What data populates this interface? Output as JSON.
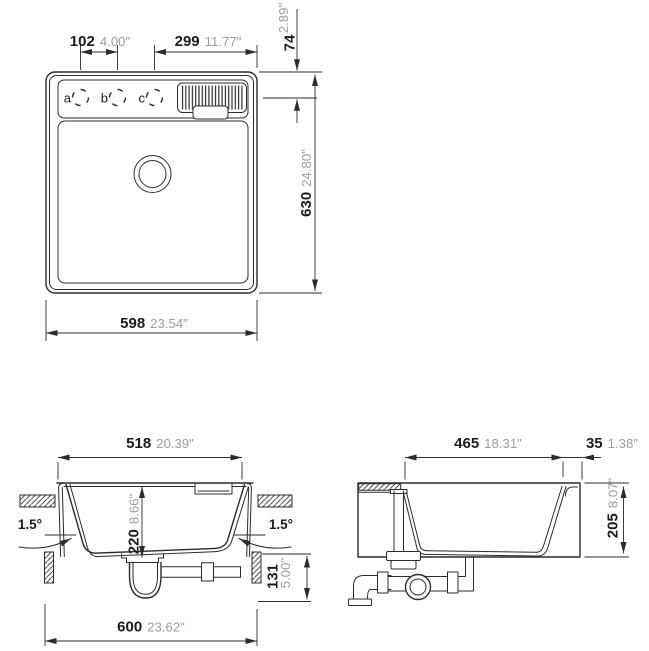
{
  "top_view": {
    "hole_labels": {
      "a": "a",
      "b": "b",
      "c": "c"
    },
    "dims": {
      "hole_spacing": {
        "mm": "102",
        "in": "4.00\""
      },
      "drainer_width": {
        "mm": "299",
        "in": "11.77\""
      },
      "edge_to_holes": {
        "mm": "74",
        "in": "2.89\""
      },
      "overall_length": {
        "mm": "630",
        "in": "24.80\""
      },
      "overall_width": {
        "mm": "598",
        "in": "23.54\""
      }
    }
  },
  "front_section": {
    "dims": {
      "bowl_width": {
        "mm": "518",
        "in": "20.39\""
      },
      "bowl_depth": {
        "mm": "220",
        "in": "8.66\""
      },
      "under_clearance": {
        "mm": "131",
        "in": "5.00\""
      },
      "cabinet_width": {
        "mm": "600",
        "in": "23.62\""
      }
    },
    "tilt_left": "1.5°",
    "tilt_right": "1.5°"
  },
  "side_section": {
    "dims": {
      "bowl_length": {
        "mm": "465",
        "in": "18.31\""
      },
      "rear_offset": {
        "mm": "35",
        "in": "1.38\""
      },
      "bowl_height": {
        "mm": "205",
        "in": "8.07\""
      }
    }
  },
  "colors": {
    "line": "#2c2c2c",
    "mm_text": "#1c1c1c",
    "inch_text": "#9d9d9d",
    "background": "#ffffff"
  }
}
